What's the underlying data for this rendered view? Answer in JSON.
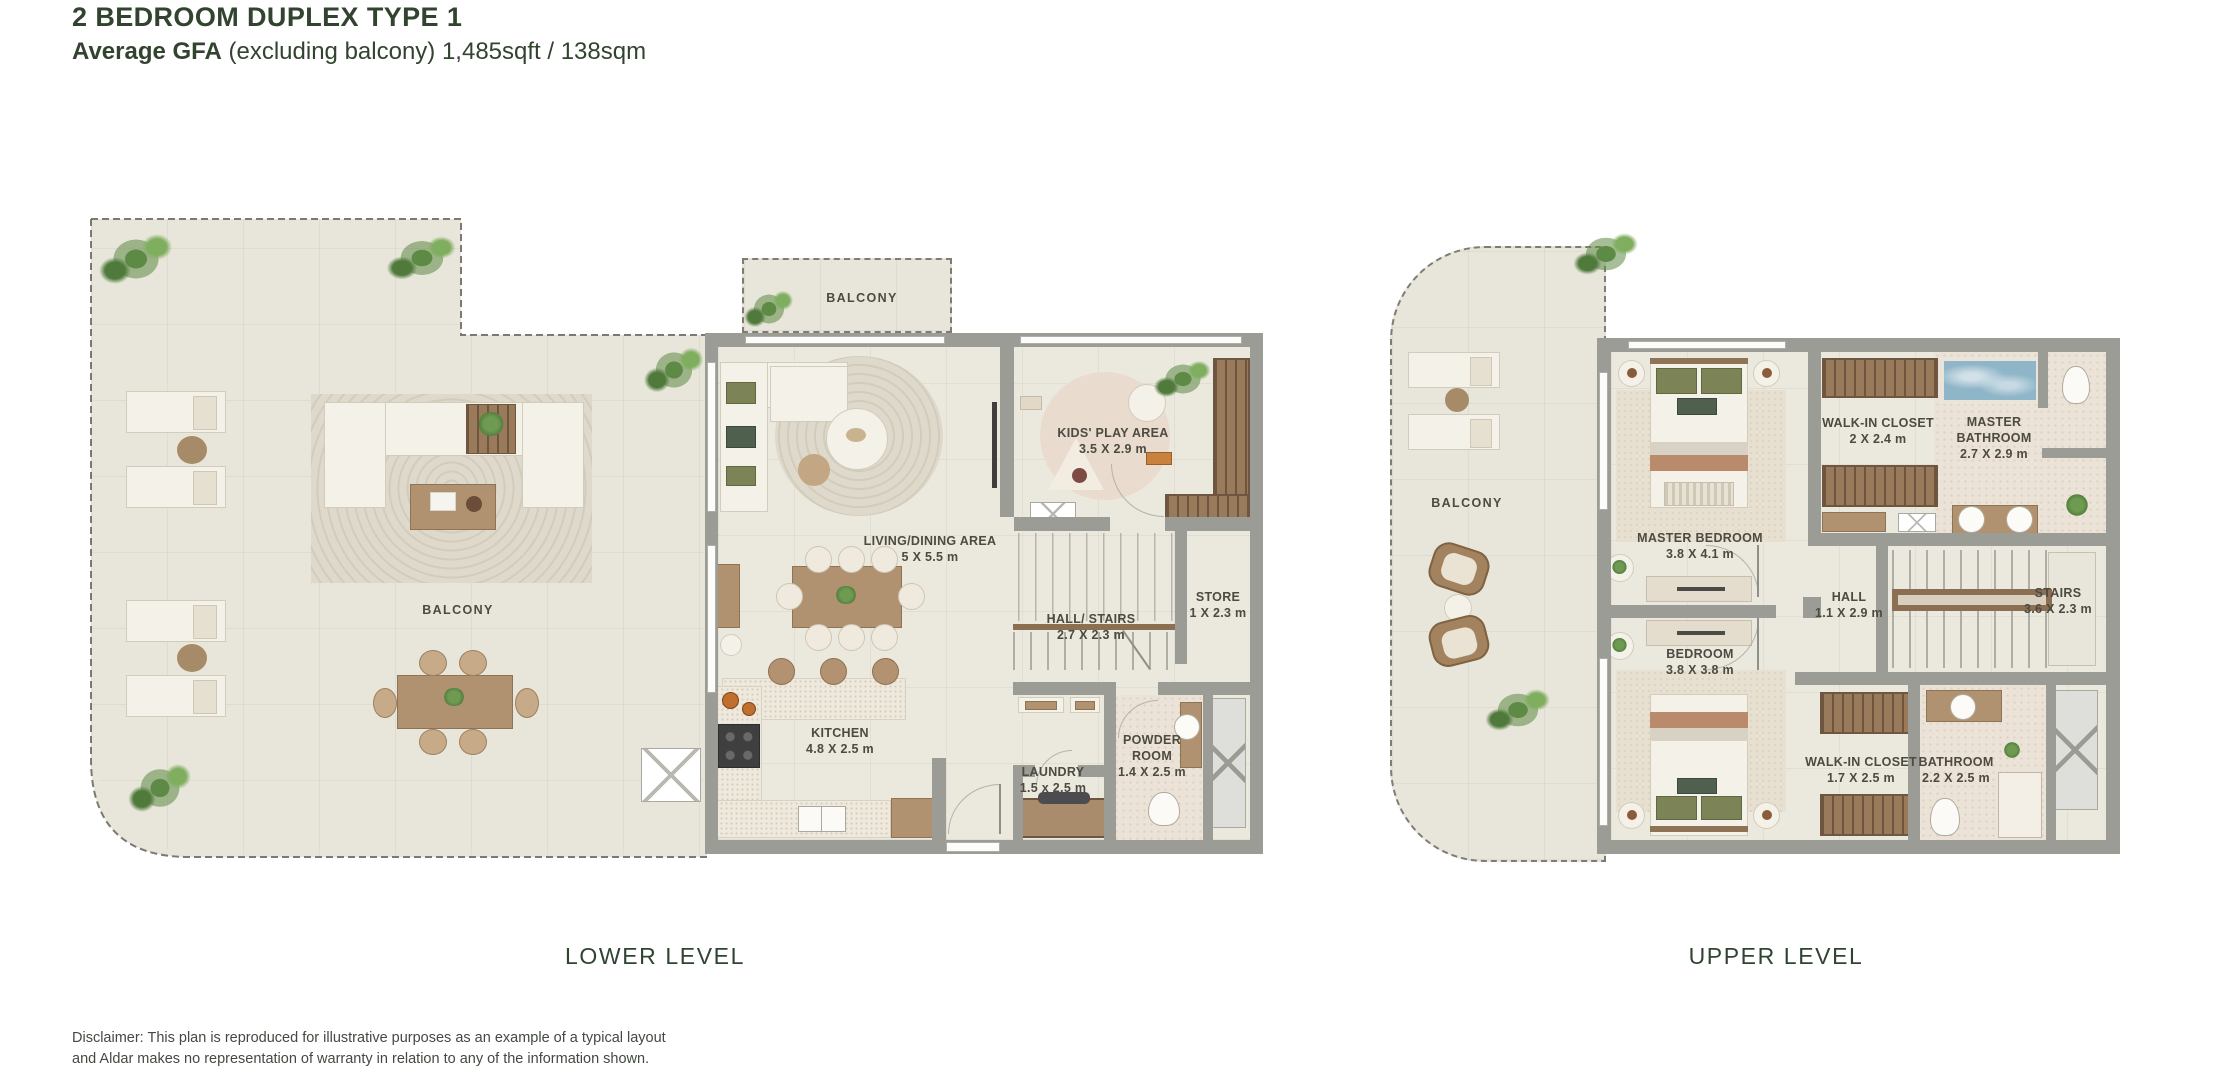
{
  "header": {
    "title": "2 BEDROOM DUPLEX TYPE 1",
    "gfa_label": "Average GFA",
    "gfa_detail": " (excluding balcony) 1,485sqft / 138sqm"
  },
  "plans": {
    "lower": {
      "caption": "LOWER LEVEL",
      "rooms": {
        "terrace": {
          "name": "BALCONY"
        },
        "balcony": {
          "name": "BALCONY"
        },
        "living": {
          "name": "LIVING/DINING AREA",
          "dims": "5 X 5.5 m"
        },
        "kids": {
          "name": "KIDS' PLAY AREA",
          "dims": "3.5 X 2.9 m"
        },
        "hall": {
          "name": "HALL/ STAIRS",
          "dims": "2.7 X 2.3 m"
        },
        "store": {
          "name": "STORE",
          "dims": "1 X 2.3 m"
        },
        "kitchen": {
          "name": "KITCHEN",
          "dims": "4.8 X 2.5 m"
        },
        "laundry": {
          "name": "LAUNDRY",
          "dims": "1.5 x 2.5 m"
        },
        "powder": {
          "name": "POWDER ROOM",
          "dims": "1.4 X 2.5 m"
        }
      }
    },
    "upper": {
      "caption": "UPPER LEVEL",
      "rooms": {
        "balcony": {
          "name": "BALCONY"
        },
        "master": {
          "name": "MASTER BEDROOM",
          "dims": "3.8 X 4.1 m"
        },
        "wic1": {
          "name": "WALK-IN CLOSET",
          "dims": "2 X 2.4 m"
        },
        "mbath": {
          "name": "MASTER BATHROOM",
          "dims": "2.7 X 2.9 m"
        },
        "hall": {
          "name": "HALL",
          "dims": "1.1 X 2.9 m"
        },
        "stairs": {
          "name": "STAIRS",
          "dims": "3.6 X 2.3 m"
        },
        "bedroom": {
          "name": "BEDROOM",
          "dims": "3.8 X 3.8 m"
        },
        "wic2": {
          "name": "WALK-IN CLOSET",
          "dims": "1.7 X 2.5 m"
        },
        "bath": {
          "name": "BATHROOM",
          "dims": "2.2 X 2.5 m"
        }
      }
    }
  },
  "disclaimer": {
    "line1": "Disclaimer: This plan is reproduced for illustrative purposes as an example of a typical layout",
    "line2": "and Aldar makes no representation of warranty in relation to any of the information shown."
  },
  "colors": {
    "heading_green": "#32432f",
    "label_gray": "#4c4a41",
    "wall_gray": "#9c9c97",
    "floor_beige": "#e8e5da",
    "wood_brown": "#b09270",
    "water_blue": "#8fb5c8",
    "plant_green": "#5d8a45"
  }
}
